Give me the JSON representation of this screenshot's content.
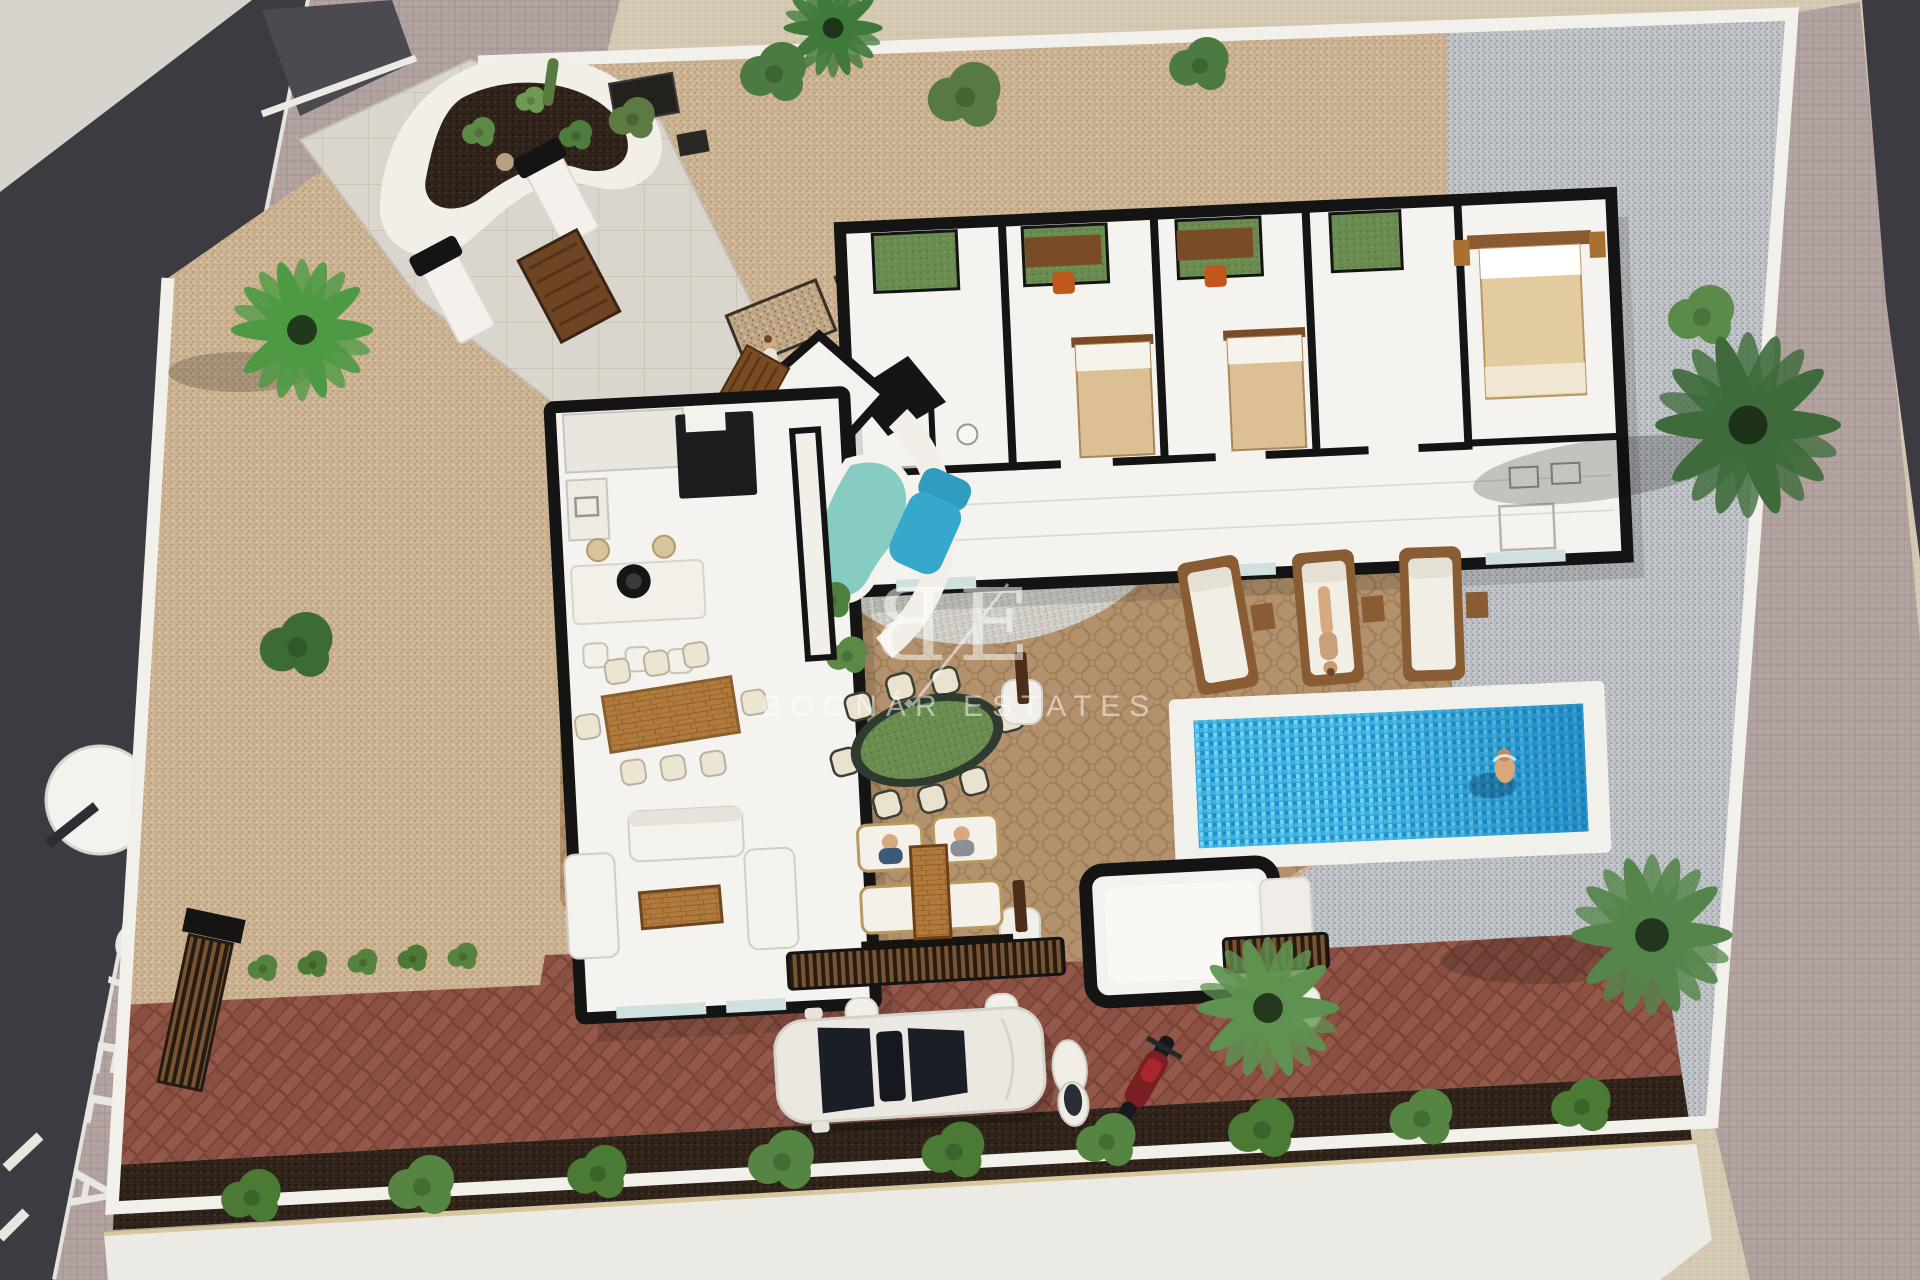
{
  "scene": {
    "description": "Aerial 3D architectural render of a single-storey villa plot with swimming pool, patios, driveway and palm trees",
    "watermark": {
      "logo_left": "B",
      "logo_right": "E",
      "name": "BOGNÁR ESTATES"
    },
    "street": {
      "name_label": "C/ EL A"
    },
    "colors": {
      "street_asphalt": "#3c3b41",
      "sidewalk_concrete": "#d7d3cd",
      "paver_sidewalk": "#b3a4a2",
      "sand_outside": "#d5c8b1",
      "plot_gravel_tan": "#cab293",
      "patio_cobble": "#b2916c",
      "gravel_grey": "#bcc0c4",
      "pebble_light": "#d0cdc6",
      "pool_water": "#2ea4d8",
      "pool_deep": "#0e6fae",
      "jacuzzi_teal": "#86ccc2",
      "brick_driveway": "#8e5447",
      "mulch_bed": "#30231a",
      "wall_white": "#f2f0ea",
      "wall_cut_black": "#141414",
      "bed_tan": "#dcc094",
      "wood_brown": "#a9712f",
      "foliage_green": "#5d8a46",
      "watermark_white": "#ffffff"
    }
  }
}
